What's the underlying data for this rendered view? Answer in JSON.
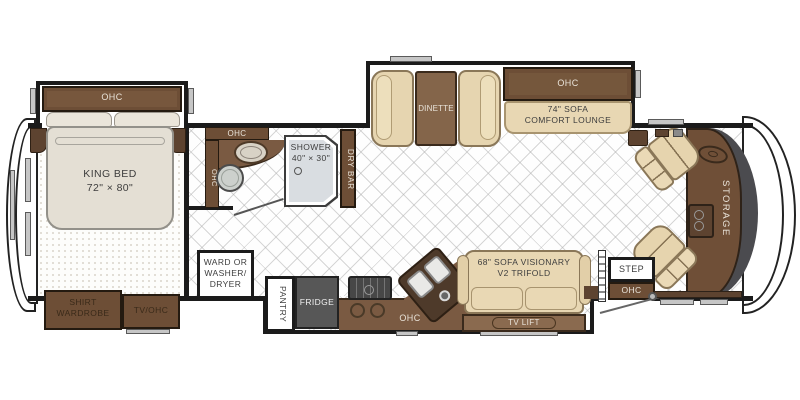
{
  "diagram_type": "rv-floor-plan",
  "bedroom": {
    "ohc_label": "OHC",
    "bed_line1": "KING BED",
    "bed_line2": "72\" × 80\"",
    "wardrobe_line1": "SHIRT",
    "wardrobe_line2": "WARDROBE",
    "tv_ohc_label": "TV/OHC"
  },
  "bathroom": {
    "ohc_top_label": "OHC",
    "ohc_side_label": "OHC",
    "shower_line1": "SHOWER",
    "shower_line2": "40\" × 30\"",
    "dry_bar_label": "DRY BAR"
  },
  "utility": {
    "ward_line1": "WARD OR",
    "ward_line2": "WASHER/",
    "ward_line3": "DRYER"
  },
  "kitchen": {
    "pantry_label": "PANTRY",
    "fridge_label": "FRIDGE",
    "ohc_label": "OHC"
  },
  "living": {
    "dinette_label": "DINETTE",
    "sofa74_ohc_label": "OHC",
    "sofa74_line1": "74\" SOFA",
    "sofa74_line2": "COMFORT LOUNGE",
    "sofa68_line1": "68\" SOFA VISIONARY",
    "sofa68_line2": "V2 TRIFOLD",
    "tv_lift_label": "TV LIFT"
  },
  "entry": {
    "step_label": "STEP",
    "ohc_label": "OHC"
  },
  "cockpit": {
    "storage_label": "STORAGE"
  },
  "colors": {
    "cabinet_brown": "#6d4e36",
    "dark_brown": "#5d4330",
    "counter_brown": "#7a5a42",
    "upholstery_beige": "#e8d7b3",
    "mattress": "#e4dfd4",
    "wall_black": "#1b1b1b",
    "fridge_gray": "#575757",
    "shower_gray": "#d9dde1",
    "label_light": "#e9e3d9",
    "label_dark": "#3d3d3d"
  }
}
